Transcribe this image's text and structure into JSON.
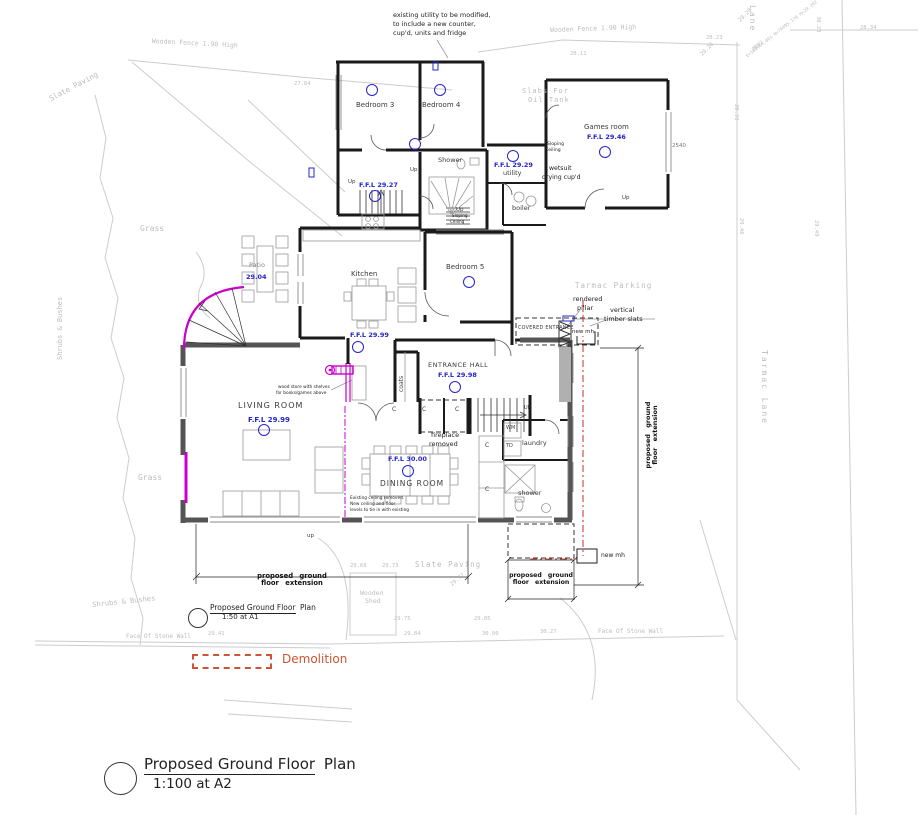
{
  "colors": {
    "ffl_blue": "#2424cc",
    "demolition_magenta": "#cc00cc",
    "legend_orange": "#cc5533",
    "drain_red": "#cc4433",
    "survey_gray": "#c4c4c4",
    "wall_black": "#1a1a1a",
    "existing_wall_gray": "#555555"
  },
  "titles": {
    "sheet_title_underlined": "Proposed Ground Floor",
    "sheet_title_tail": "Plan",
    "main_scale": "1:100 at A2",
    "inset_scale": "1:50 at A1"
  },
  "legend": {
    "demolition": "Demolition"
  },
  "rooms": {
    "bedroom3": "Bedroom 3",
    "bedroom4": "Bedroom 4",
    "bedroom5": "Bedroom 5",
    "games_room": "Games room",
    "games_ffl": "F.F.L 29.46",
    "shower_top": "Shower",
    "utility": "utility",
    "utility_ffl": "F.F.L 29.29",
    "boiler": "boiler",
    "kitchen": "Kitchen",
    "kitchen_ffl": "F.F.L 29.99",
    "patio": "Patio",
    "patio_level": "29.04",
    "entrance_hall": "ENTRANCE HALL",
    "entrance_ffl": "F.F.L 29.98",
    "living_room": "LIVING ROOM",
    "living_ffl": "F.F.L 29.99",
    "dining_room": "DINING ROOM",
    "dining_ffl": "F.F.L 30.00",
    "laundry": "laundry",
    "shower_bottom": "shower",
    "coats": "coats",
    "covered_entrance": "COVERED ENTRANCE",
    "landing_ffl": "F.F.L 29.27"
  },
  "annotations": {
    "utility_note": [
      "existing utility to be modified,",
      "to include a new counter,",
      "cup'd, units and fridge"
    ],
    "wetsuit": [
      "wetsuit",
      "drying cup'd"
    ],
    "sloping_ceiling": [
      "Sloping",
      "Ceiling"
    ],
    "fireplace": [
      "fireplace",
      "removed"
    ],
    "wood_store": [
      "wood store with shelves",
      "for books/games above"
    ],
    "ceiling_note": [
      "Existing ceiling removed.",
      "New ceiling and floor",
      "levels to tie in with existing"
    ],
    "rendered_pillar": [
      "rendered",
      "pillar"
    ],
    "timber_slats": [
      "vertical",
      "timber slats"
    ],
    "new_mh": "new mh",
    "extension": [
      "proposed ground",
      "floor extension"
    ]
  },
  "site": {
    "wooden_fence": "Wooden Fence 1.90 High",
    "slate_paving": "Slate Paving",
    "grass": "Grass",
    "shrubs": "Shrubs & Bushes",
    "slabs": [
      "Slabs For",
      "Oil Tank"
    ],
    "tarmac_parking": "Tarmac Parking",
    "tarmac_lane": "Tarmac Lane",
    "lane": "Lane",
    "wooden_shed": [
      "Wooden",
      "Shed"
    ],
    "stone_wall": "Face Of Stone Wall",
    "station_id": "MP02",
    "station_data": "E=169464.091 N=79495.178 H=29.292",
    "dim_2540": "2540"
  },
  "small": {
    "up": "Up",
    "up_caps": "UP",
    "up_lower": "up",
    "wm": "WM",
    "td": "TD",
    "c": "C"
  },
  "spot_levels": [
    "27.84",
    "28.11",
    "28.23",
    "28.26",
    "28.28",
    "28.34",
    "28.31",
    "30.23",
    "29.46",
    "29.49",
    "29.68",
    "29.73",
    "29.75",
    "29.77",
    "29.84",
    "29.85",
    "30.00",
    "30.27",
    "29.41"
  ]
}
